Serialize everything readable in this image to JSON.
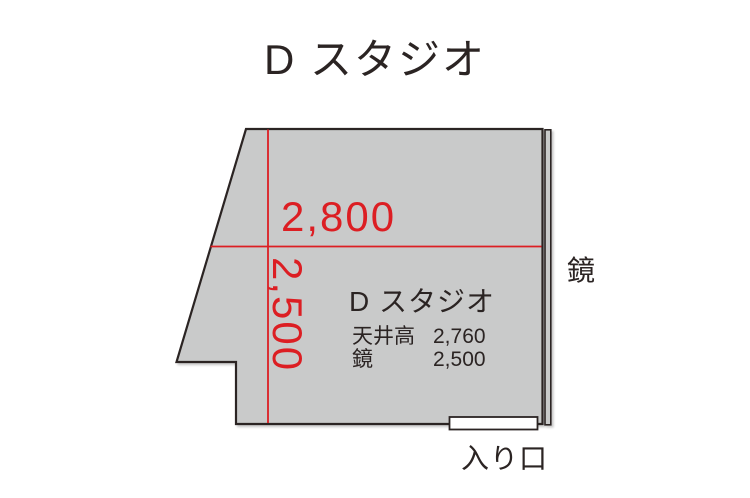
{
  "page": {
    "title": "D スタジオ"
  },
  "floorplan": {
    "room_name": "D スタジオ",
    "width_dimension": "2,800",
    "depth_dimension": "2,500",
    "specs": [
      {
        "label": "天井高",
        "value": "2,760"
      },
      {
        "label": "鏡",
        "value": "2,500"
      }
    ],
    "mirror_label": "鏡",
    "entrance_label": "入り口"
  },
  "colors": {
    "room_fill": "#c9caca",
    "outline": "#2b2423",
    "dimension_red": "#dc1e23",
    "entrance_fill": "#ffffff"
  }
}
